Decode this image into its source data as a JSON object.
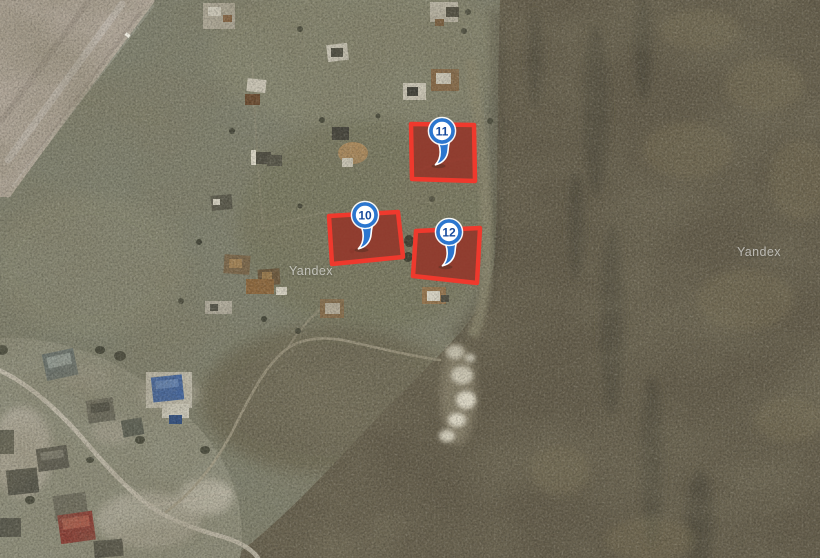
{
  "map": {
    "view": "satellite",
    "watermarks": [
      {
        "text": "Yandex",
        "x": 289,
        "y": 264
      },
      {
        "text": "Yandex",
        "x": 737,
        "y": 245
      }
    ],
    "markers": [
      {
        "label": "10",
        "cx": 365,
        "cy": 215
      },
      {
        "label": "11",
        "cx": 442,
        "cy": 131
      },
      {
        "label": "12",
        "cx": 449,
        "cy": 232
      }
    ],
    "plots": [
      {
        "label": "10",
        "points": [
          [
            329,
            216
          ],
          [
            398,
            212
          ],
          [
            403,
            257
          ],
          [
            332,
            264
          ]
        ]
      },
      {
        "label": "11",
        "points": [
          [
            411,
            124
          ],
          [
            474,
            125
          ],
          [
            475,
            181
          ],
          [
            412,
            179
          ]
        ]
      },
      {
        "label": "12",
        "points": [
          [
            416,
            231
          ],
          [
            480,
            228
          ],
          [
            477,
            283
          ],
          [
            413,
            276
          ]
        ]
      }
    ],
    "colors": {
      "plot_stroke": "#ef392d",
      "plot_fill": "rgba(200,35,25,0.38)",
      "plot_ground": "rgba(109,70,54,0.82)",
      "marker_ring": "#2b76cf",
      "marker_label": "#174a9c",
      "watermark": "rgba(255,255,255,0.58)"
    }
  }
}
